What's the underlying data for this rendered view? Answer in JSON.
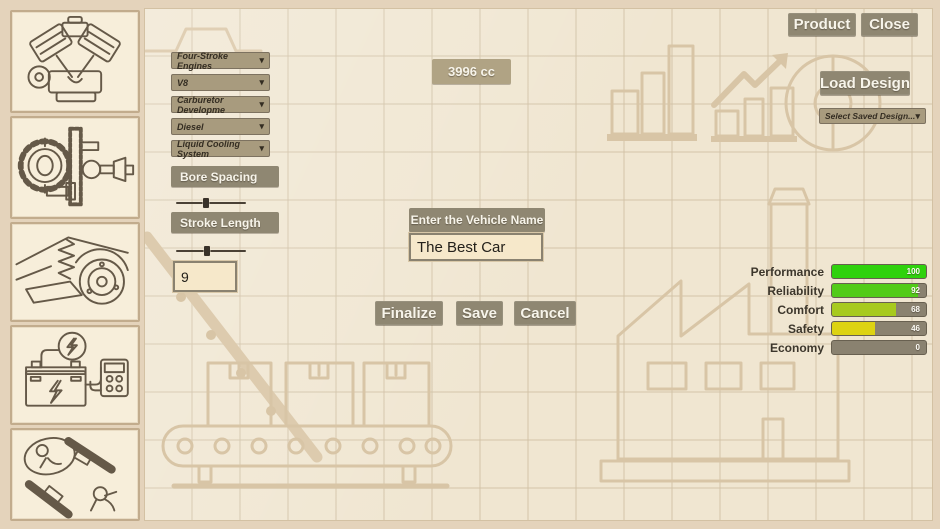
{
  "topbar": {
    "product_label": "Product",
    "close_label": "Close"
  },
  "engine_config": {
    "dropdowns": [
      {
        "label": "Four-Stroke Engines"
      },
      {
        "label": "V8"
      },
      {
        "label": "Carburetor Developme"
      },
      {
        "label": "Diesel"
      },
      {
        "label": "Liquid Cooling System"
      }
    ],
    "bore_spacing_label": "Bore Spacing",
    "bore_spacing_pos": 38,
    "stroke_length_label": "Stroke Length",
    "stroke_length_pos": 40,
    "stroke_value": "9",
    "displacement_label": "3996 cc"
  },
  "vehicle_form": {
    "name_label": "Enter the Vehicle Name",
    "name_value": "The Best Car",
    "finalize_label": "Finalize",
    "save_label": "Save",
    "cancel_label": "Cancel"
  },
  "load_design": {
    "button_label": "Load Design",
    "dropdown_label": "Select Saved Design...",
    "chevron": "▾"
  },
  "icons": {
    "chevron": "▾"
  },
  "stats": {
    "rows": [
      {
        "label": "Performance",
        "value": 100,
        "color": "#2fd20d"
      },
      {
        "label": "Reliability",
        "value": 92,
        "color": "#52cb18"
      },
      {
        "label": "Comfort",
        "value": 68,
        "color": "#a7ca1e"
      },
      {
        "label": "Safety",
        "value": 46,
        "color": "#ddd312"
      },
      {
        "label": "Economy",
        "value": 0,
        "color": "#8a8270"
      }
    ],
    "track_color": "#8a8270"
  },
  "sidebar": {
    "items": [
      {
        "name": "engine"
      },
      {
        "name": "drivetrain"
      },
      {
        "name": "suspension"
      },
      {
        "name": "electrics"
      },
      {
        "name": "safety"
      }
    ]
  },
  "colors": {
    "button": "#8f8772",
    "panel": "#f0e6d1",
    "frame": "#e4d3bb",
    "sketch": "#d8c5a6"
  }
}
